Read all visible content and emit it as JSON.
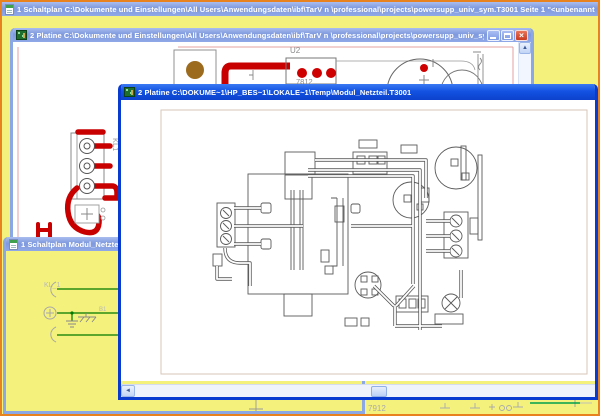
{
  "colors": {
    "desktop_yellow": "#F4F17C",
    "frame_orange": "#E8821F",
    "active_title_blue": "#1353E2",
    "inactive_title_blue": "#8FA8E6",
    "trace_red": "#C80000",
    "pad_brown": "#9C6B1E",
    "wire_green": "#007A00",
    "sheet_border_pink": "#E4A0A0"
  },
  "icons": {
    "close": "×",
    "scroll_up": "▲",
    "scroll_left": "◄",
    "document": "document-icon",
    "pcb": "pcb-icon"
  },
  "window1": {
    "title": "1 Schaltplan C:\\Dokumente und Einstellungen\\All Users\\Anwendungsdaten\\ibf\\TarV n \\professional\\projects\\powersupp_univ_sym.T3001 Seite 1 \"<unbenannt>\""
  },
  "window2": {
    "title": "2 Platine C:\\Dokumente und Einstellungen\\All Users\\Anwendungsdaten\\ibf\\TarV n \\professional\\projects\\powersupp_univ_sym.T30...",
    "pcb_labels": {
      "u2": "U2",
      "regulator": "7812",
      "connector": "KL1"
    }
  },
  "window3": {
    "title": "1 Schaltplan Modul_Netzteil.",
    "schematic_labels": {
      "connector": "KL_1",
      "part": "B1"
    }
  },
  "window4": {
    "title": "2 Platine C:\\DOKUME~1\\HP_BES~1\\LOKALE~1\\Temp\\Modul_Netzteil.T3001"
  },
  "desktop_schematic": {
    "regulator": "7912"
  }
}
